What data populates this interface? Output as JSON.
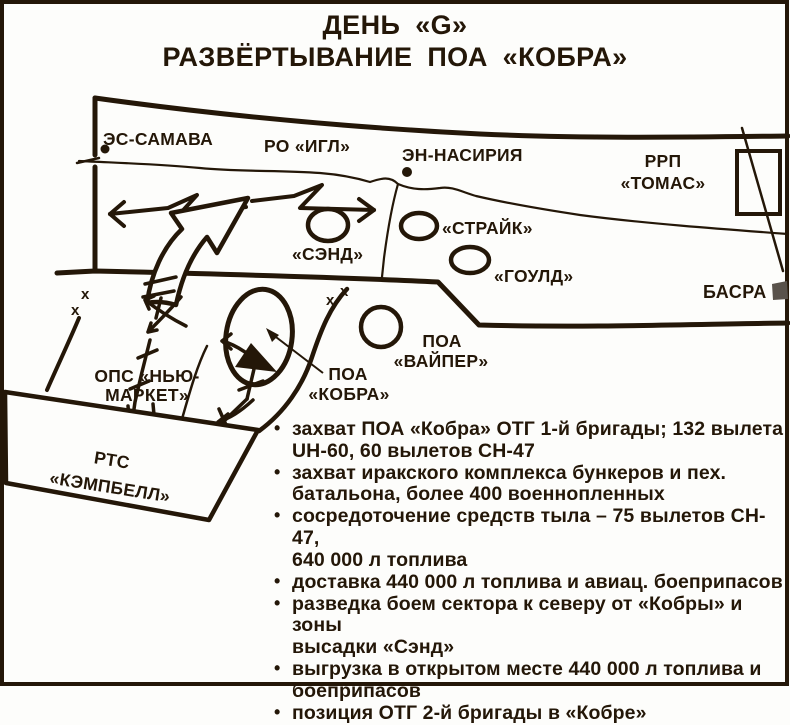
{
  "title": {
    "line1": "ДЕНЬ «G»",
    "line2": "РАЗВЁРТЫВАНИЕ ПОА «КОБРА»"
  },
  "map": {
    "labels": {
      "es_samawa": "ЭС-САМАВА",
      "ro_eagle": "РО «ИГЛ»",
      "en_nasiriya": "ЭН-НАСИРИЯ",
      "rrp_thomas_line1": "РРП",
      "rrp_thomas_line2": "«ТОМАС»",
      "strike": "«СТРАЙК»",
      "gold": "«ГОУЛД»",
      "sand": "«СЭНД»",
      "basra": "БАСРА",
      "poa_viper_line1": "ПОА",
      "poa_viper_line2": "«ВАЙПЕР»",
      "poa_cobra_line1": "ПОА",
      "poa_cobra_line2": "«КОБРА»",
      "ops_newmarket_line1": "ОПС «НЬЮ-",
      "ops_newmarket_line2": "МАРКЕТ»",
      "rts_campbell_line1": "РТС",
      "rts_campbell_line2": "«КЭМПБЕЛЛ»",
      "boundary_mark": "x"
    }
  },
  "notes": {
    "items": [
      "захват ПОА «Кобра» ОТГ 1-й бригады; 132 вылета\nUH-60, 60 вылетов CH-47",
      "захват иракского комплекса бункеров и пех.\nбатальона, более 400 военнопленных",
      "сосредоточение средств тыла – 75 вылетов CH-47,\n640 000 л топлива",
      "доставка 440 000 л топлива и авиац. боеприпасов",
      "разведка боем сектора к северу от «Кобры» и зоны\nвысадки «Сэнд»",
      "выгрузка в открытом месте 440 000 л топлива и\nбоеприпасов",
      "позиция ОТГ 2-й бригады в «Кобре»"
    ]
  },
  "colors": {
    "ink": "#241708",
    "paper": "#fdfdfb",
    "basra_fill": "#59524b"
  }
}
